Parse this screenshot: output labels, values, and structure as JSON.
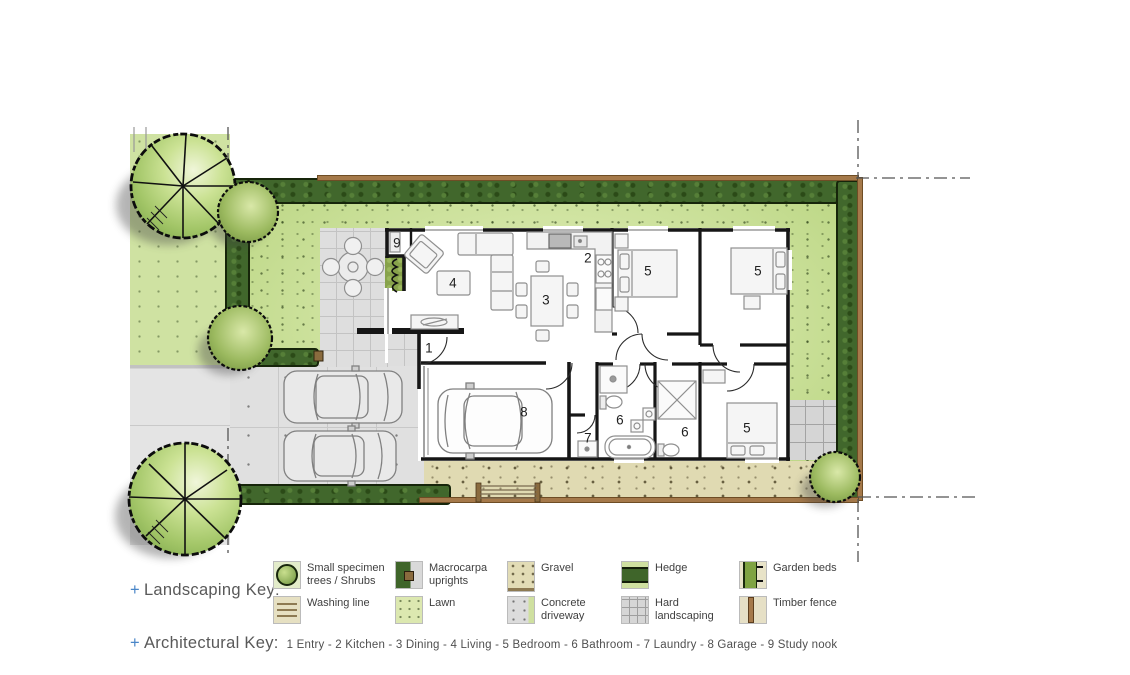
{
  "plan": {
    "rooms": [
      {
        "num": "1",
        "name": "Entry"
      },
      {
        "num": "2",
        "name": "Kitchen"
      },
      {
        "num": "3",
        "name": "Dining"
      },
      {
        "num": "4",
        "name": "Living"
      },
      {
        "num": "5",
        "name": "Bedroom"
      },
      {
        "num": "6",
        "name": "Bathroom"
      },
      {
        "num": "7",
        "name": "Laundry"
      },
      {
        "num": "8",
        "name": "Garage"
      },
      {
        "num": "9",
        "name": "Study nook"
      }
    ]
  },
  "legend": {
    "plus": "+",
    "landscaping_title": "Landscaping Key:",
    "architectural_title": "Architectural Key:",
    "architectural_items": "1 Entry - 2 Kitchen - 3 Dining - 4 Living - 5 Bedroom - 6 Bathroom - 7 Laundry - 8 Garage - 9 Study nook",
    "items": [
      {
        "label": "Small specimen trees / Shrubs",
        "icon": "shrub-swatch"
      },
      {
        "label": "Macrocarpa uprights",
        "icon": "macrocarpa-swatch"
      },
      {
        "label": "Gravel",
        "icon": "gravel-swatch"
      },
      {
        "label": "Hedge",
        "icon": "hedge-swatch"
      },
      {
        "label": "Garden beds",
        "icon": "garden-beds-swatch"
      },
      {
        "label": "Washing line",
        "icon": "washing-line-swatch"
      },
      {
        "label": "Lawn",
        "icon": "lawn-swatch"
      },
      {
        "label": "Concrete driveway",
        "icon": "concrete-swatch"
      },
      {
        "label": "Hard landscaping",
        "icon": "hard-landscaping-swatch"
      },
      {
        "label": "Timber fence",
        "icon": "timber-fence-swatch"
      }
    ]
  },
  "colors": {
    "lawn": "#cfe3a0",
    "hedge": "#41672c",
    "fence": "#a5794a",
    "gravel": "#e0dab2",
    "concrete": "#e0e0e0",
    "garden_bed": "#87a24b",
    "accent_blue": "#4a86c8"
  }
}
